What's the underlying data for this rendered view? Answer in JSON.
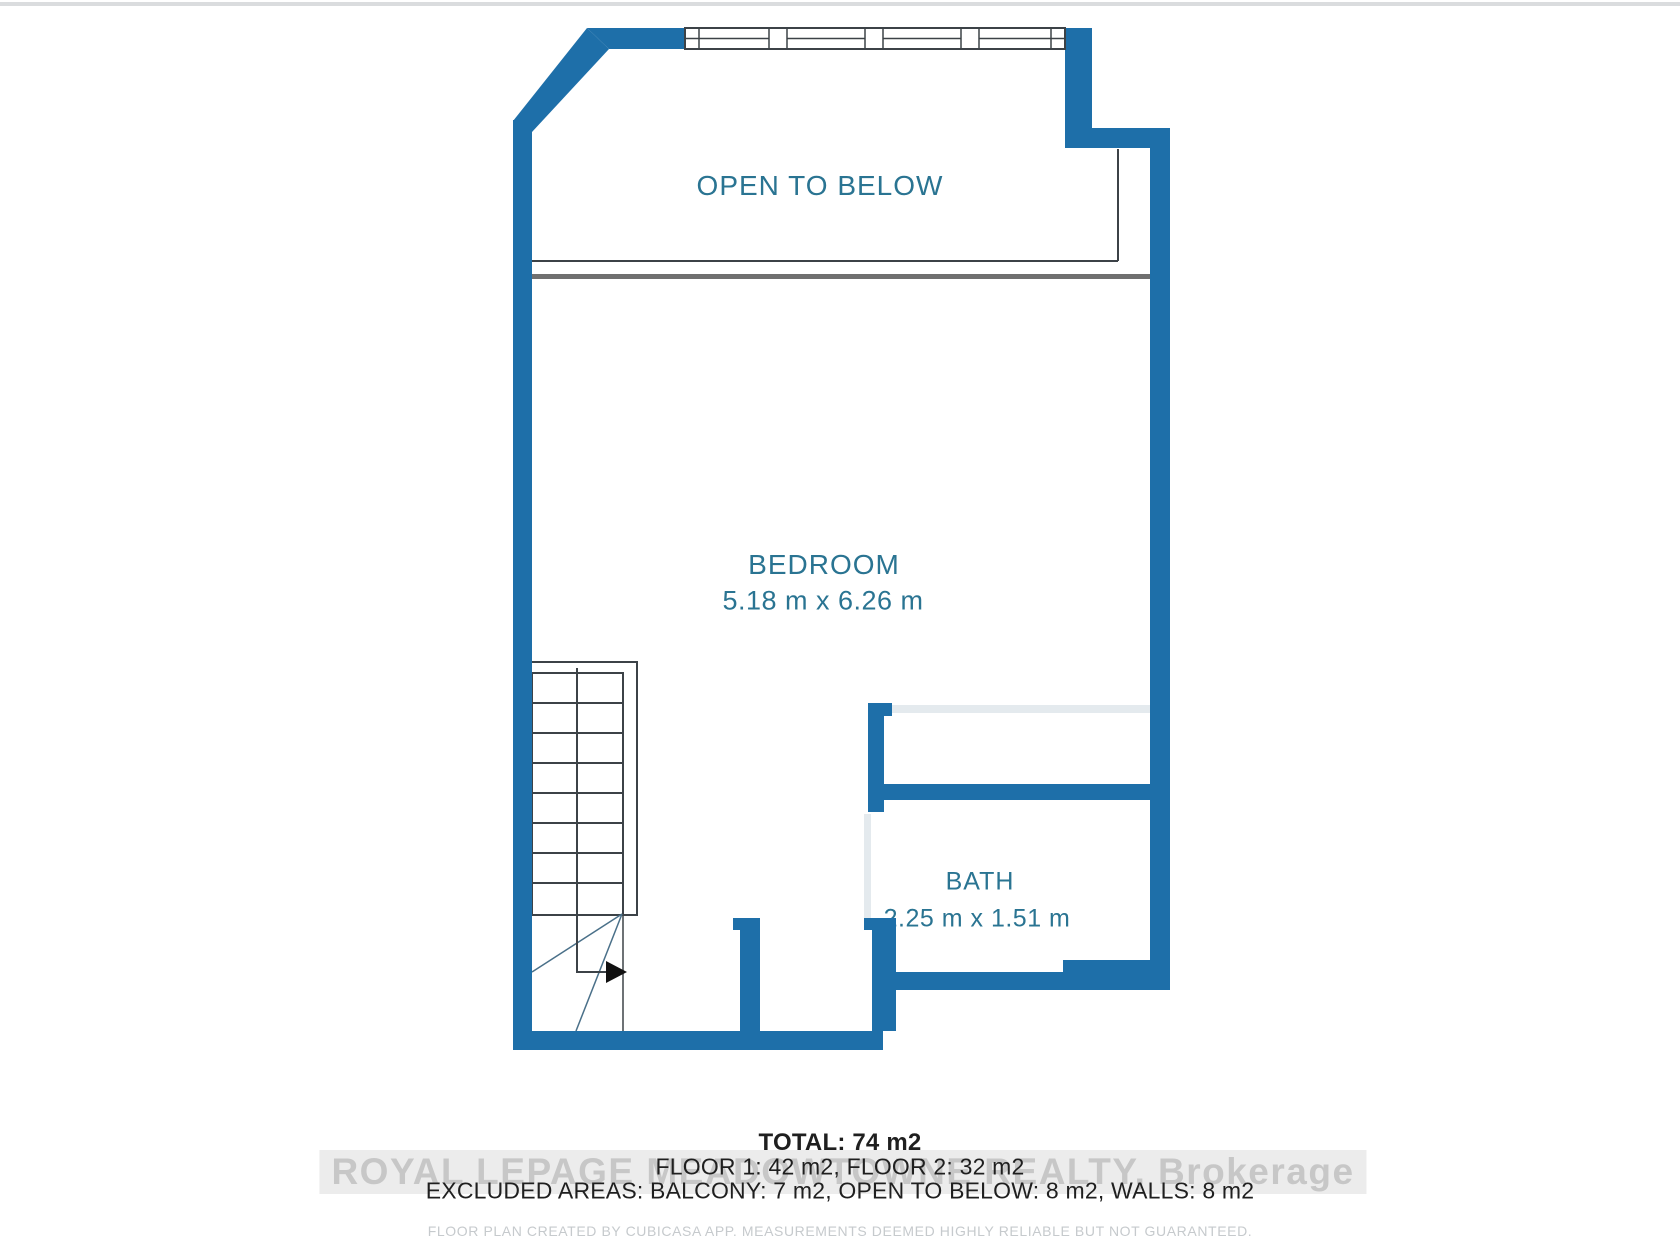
{
  "rooms": {
    "open_to_below": {
      "label": "OPEN TO BELOW"
    },
    "bedroom": {
      "label": "BEDROOM",
      "dimensions": "5.18 m x 6.26 m"
    },
    "bath": {
      "label": "BATH",
      "dimensions": "2.25 m x 1.51 m"
    }
  },
  "summary": {
    "total": "TOTAL: 74 m2",
    "floors": "FLOOR 1: 42 m2, FLOOR 2: 32 m2",
    "excluded": "EXCLUDED AREAS: BALCONY: 7 m2, OPEN TO BELOW: 8 m2, WALLS: 8 m2"
  },
  "watermark": {
    "text": "ROYAL LEPAGE MEADOWTOWNE REALTY, Brokerage"
  },
  "footer": {
    "text": "FLOOR PLAN CREATED BY CUBICASA APP. MEASUREMENTS DEEMED HIGHLY RELIABLE BUT NOT GUARANTEED."
  },
  "colors": {
    "wall": "#1e6fa9",
    "label": "#2a7492",
    "outline": "#3c4247",
    "divider": "#707070",
    "winder": "#4a7089",
    "lightLine": "#e4eaee",
    "textDark": "#1f1f1f",
    "watermark": "#c7c7c7",
    "footer": "#c6cacd",
    "arrow": "#111111"
  }
}
